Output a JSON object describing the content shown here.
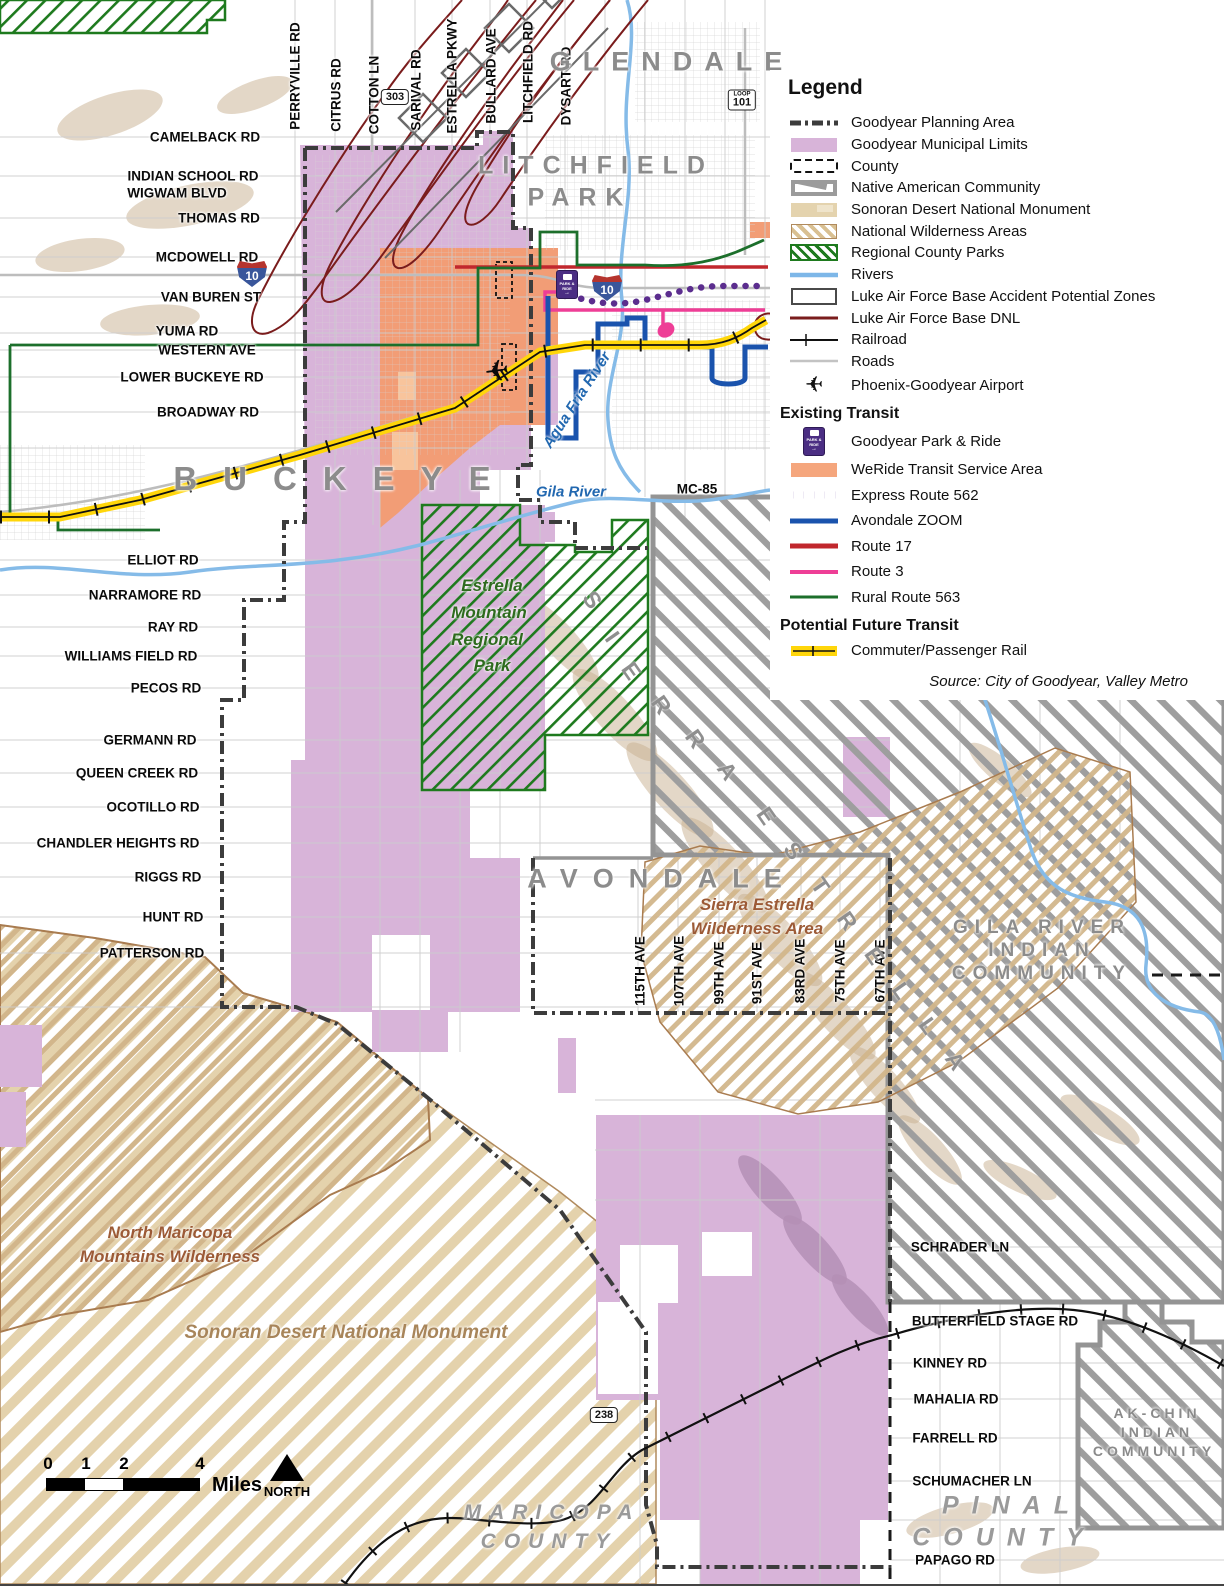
{
  "legend": {
    "title": "Legend",
    "items": [
      {
        "label": "Goodyear Planning Area"
      },
      {
        "label": "Goodyear Municipal Limits"
      },
      {
        "label": "County"
      },
      {
        "label": "Native American Community"
      },
      {
        "label": "Sonoran Desert National Monument"
      },
      {
        "label": "National Wilderness Areas"
      },
      {
        "label": "Regional County Parks"
      },
      {
        "label": "Rivers"
      },
      {
        "label": "Luke Air Force Base Accident Potential Zones"
      },
      {
        "label": "Luke Air Force Base DNL"
      },
      {
        "label": "Railroad"
      },
      {
        "label": "Roads"
      },
      {
        "label": "Phoenix-Goodyear Airport"
      }
    ],
    "existing_transit": {
      "header": "Existing Transit",
      "items": [
        {
          "label": "Goodyear Park & Ride"
        },
        {
          "label": "WeRide Transit Service Area"
        },
        {
          "label": "Express Route 562"
        },
        {
          "label": "Avondale ZOOM"
        },
        {
          "label": "Route 17"
        },
        {
          "label": "Route 3"
        },
        {
          "label": "Rural Route 563"
        }
      ]
    },
    "future_transit": {
      "header": "Potential Future Transit",
      "items": [
        {
          "label": "Commuter/Passenger Rail"
        }
      ]
    },
    "source": "Source: City of Goodyear, Valley Metro"
  },
  "shields": {
    "i10": "10",
    "loop_word": "LOOP",
    "loop101": "101",
    "sr303": "303",
    "sr238": "238"
  },
  "icons": {
    "airplane": "✈"
  },
  "park_ride_icon": {
    "line1": "PARK &",
    "line2": "RIDE",
    "arrow": "→"
  },
  "scale_bar": {
    "ticks": [
      "0",
      "1",
      "2",
      "4"
    ],
    "unit": "Miles",
    "north": "NORTH"
  },
  "map_labels": {
    "roads": [
      {
        "t": "CAMELBACK RD",
        "x": 205,
        "y": 137
      },
      {
        "t": "INDIAN SCHOOL RD",
        "x": 193,
        "y": 176
      },
      {
        "t": "WIGWAM BLVD",
        "x": 177,
        "y": 193
      },
      {
        "t": "THOMAS RD",
        "x": 219,
        "y": 218
      },
      {
        "t": "MCDOWELL RD",
        "x": 207,
        "y": 257
      },
      {
        "t": "VAN BUREN ST",
        "x": 211,
        "y": 297
      },
      {
        "t": "YUMA RD",
        "x": 187,
        "y": 331
      },
      {
        "t": "WESTERN AVE",
        "x": 207,
        "y": 350
      },
      {
        "t": "LOWER BUCKEYE RD",
        "x": 192,
        "y": 377
      },
      {
        "t": "BROADWAY RD",
        "x": 208,
        "y": 412
      },
      {
        "t": "MC-85",
        "x": 697,
        "y": 489
      },
      {
        "t": "ELLIOT RD",
        "x": 163,
        "y": 560
      },
      {
        "t": "NARRAMORE RD",
        "x": 145,
        "y": 595
      },
      {
        "t": "RAY RD",
        "x": 173,
        "y": 627
      },
      {
        "t": "WILLIAMS FIELD RD",
        "x": 131,
        "y": 656
      },
      {
        "t": "PECOS RD",
        "x": 166,
        "y": 688
      },
      {
        "t": "GERMANN RD",
        "x": 150,
        "y": 740
      },
      {
        "t": "QUEEN CREEK RD",
        "x": 137,
        "y": 773
      },
      {
        "t": "OCOTILLO RD",
        "x": 153,
        "y": 807
      },
      {
        "t": "CHANDLER HEIGHTS RD",
        "x": 118,
        "y": 843
      },
      {
        "t": "RIGGS RD",
        "x": 168,
        "y": 877
      },
      {
        "t": "HUNT RD",
        "x": 173,
        "y": 917
      },
      {
        "t": "PATTERSON RD",
        "x": 152,
        "y": 953
      },
      {
        "t": "SCHRADER LN",
        "x": 960,
        "y": 1247
      },
      {
        "t": "BUTTERFIELD STAGE RD",
        "x": 995,
        "y": 1321
      },
      {
        "t": "KINNEY RD",
        "x": 950,
        "y": 1363
      },
      {
        "t": "MAHALIA RD",
        "x": 956,
        "y": 1399
      },
      {
        "t": "FARRELL RD",
        "x": 955,
        "y": 1438
      },
      {
        "t": "SCHUMACHER LN",
        "x": 972,
        "y": 1481
      },
      {
        "t": "PAPAGO RD",
        "x": 955,
        "y": 1560
      }
    ],
    "streets_vertical": [
      {
        "t": "PERRYVILLE RD",
        "x": 295,
        "y": 76,
        "r": -90
      },
      {
        "t": "CITRUS RD",
        "x": 336,
        "y": 95,
        "r": -90
      },
      {
        "t": "COTTON LN",
        "x": 374,
        "y": 95,
        "r": -90
      },
      {
        "t": "SARIVAL RD",
        "x": 416,
        "y": 90,
        "r": -90
      },
      {
        "t": "ESTRELLA PKWY",
        "x": 452,
        "y": 76,
        "r": -90
      },
      {
        "t": "BULLARD AVE",
        "x": 491,
        "y": 76,
        "r": -90
      },
      {
        "t": "LITCHFIELD RD",
        "x": 528,
        "y": 72,
        "r": -90
      },
      {
        "t": "DYSART RD",
        "x": 566,
        "y": 86,
        "r": -90
      },
      {
        "t": "115TH AVE",
        "x": 640,
        "y": 971,
        "r": -90
      },
      {
        "t": "107TH AVE",
        "x": 679,
        "y": 971,
        "r": -90
      },
      {
        "t": "99TH AVE",
        "x": 719,
        "y": 973,
        "r": -90
      },
      {
        "t": "91ST AVE",
        "x": 757,
        "y": 973,
        "r": -90
      },
      {
        "t": "83RD AVE",
        "x": 800,
        "y": 971,
        "r": -90
      },
      {
        "t": "75TH AVE",
        "x": 840,
        "y": 971,
        "r": -90
      },
      {
        "t": "67TH AVE",
        "x": 880,
        "y": 971,
        "r": -90
      }
    ],
    "cities": [
      {
        "t": "GLENDALE",
        "x": 672,
        "y": 62,
        "c": "c1"
      },
      {
        "t": "LITCHFIELD",
        "x": 596,
        "y": 166,
        "c": "c2"
      },
      {
        "t": "PARK",
        "x": 580,
        "y": 198,
        "c": "c2"
      },
      {
        "t": "BUCKEYE",
        "x": 345,
        "y": 479,
        "c": "c0"
      },
      {
        "t": "AVONDALE",
        "x": 662,
        "y": 879,
        "c": "c2b"
      },
      {
        "t": "GILA RIVER",
        "x": 1042,
        "y": 928,
        "c": "c3"
      },
      {
        "t": "INDIAN",
        "x": 1042,
        "y": 951,
        "c": "c3"
      },
      {
        "t": "COMMUNITY",
        "x": 1042,
        "y": 974,
        "c": "c3"
      },
      {
        "t": "AK-CHIN",
        "x": 1157,
        "y": 1413,
        "c": "c4"
      },
      {
        "t": "INDIAN",
        "x": 1157,
        "y": 1432,
        "c": "c4"
      },
      {
        "t": "COMMUNITY",
        "x": 1154,
        "y": 1451,
        "c": "c4"
      },
      {
        "t": "PINAL",
        "x": 1012,
        "y": 1506,
        "c": "c5"
      },
      {
        "t": "COUNTY",
        "x": 1004,
        "y": 1538,
        "c": "c5"
      },
      {
        "t": "MARICOPA",
        "x": 552,
        "y": 1513,
        "c": "c6"
      },
      {
        "t": "COUNTY",
        "x": 549,
        "y": 1542,
        "c": "c6"
      }
    ],
    "features": [
      {
        "t": "Gila River",
        "x": 571,
        "y": 492,
        "c": "riv"
      },
      {
        "t": "Agua Fria River",
        "x": 577,
        "y": 400,
        "c": "riv",
        "r": -57
      },
      {
        "t": "Estrella",
        "x": 492,
        "y": 586,
        "c": "park"
      },
      {
        "t": "Mountain",
        "x": 489,
        "y": 613,
        "c": "park"
      },
      {
        "t": "Regional",
        "x": 487,
        "y": 640,
        "c": "park"
      },
      {
        "t": "Park",
        "x": 492,
        "y": 666,
        "c": "park"
      },
      {
        "t": "Sierra Estrella",
        "x": 757,
        "y": 905,
        "c": "wild"
      },
      {
        "t": "Wilderness Area",
        "x": 757,
        "y": 929,
        "c": "wild"
      },
      {
        "t": "North Maricopa",
        "x": 170,
        "y": 1233,
        "c": "wild"
      },
      {
        "t": "Mountains Wilderness",
        "x": 170,
        "y": 1257,
        "c": "wild"
      },
      {
        "t": "Sonoran Desert National Monument",
        "x": 346,
        "y": 1333,
        "c": "mon"
      }
    ],
    "ridge_letters": [
      {
        "t": "S",
        "x": 592,
        "y": 600,
        "r": 55
      },
      {
        "t": "I",
        "x": 612,
        "y": 637,
        "r": 55
      },
      {
        "t": "E",
        "x": 631,
        "y": 671,
        "r": 55
      },
      {
        "t": "R",
        "x": 661,
        "y": 705,
        "r": 55
      },
      {
        "t": "R",
        "x": 695,
        "y": 739,
        "r": 55
      },
      {
        "t": "A",
        "x": 727,
        "y": 771,
        "r": 55
      },
      {
        "t": "E",
        "x": 766,
        "y": 816,
        "r": 55
      },
      {
        "t": "S",
        "x": 793,
        "y": 851,
        "r": 55
      },
      {
        "t": "T",
        "x": 820,
        "y": 886,
        "r": 55
      },
      {
        "t": "R",
        "x": 847,
        "y": 921,
        "r": 55
      },
      {
        "t": "E",
        "x": 874,
        "y": 956,
        "r": 55
      },
      {
        "t": "L",
        "x": 901,
        "y": 991,
        "r": 55
      },
      {
        "t": "L",
        "x": 928,
        "y": 1026,
        "r": 55
      },
      {
        "t": "A",
        "x": 955,
        "y": 1061,
        "r": 55
      }
    ]
  }
}
